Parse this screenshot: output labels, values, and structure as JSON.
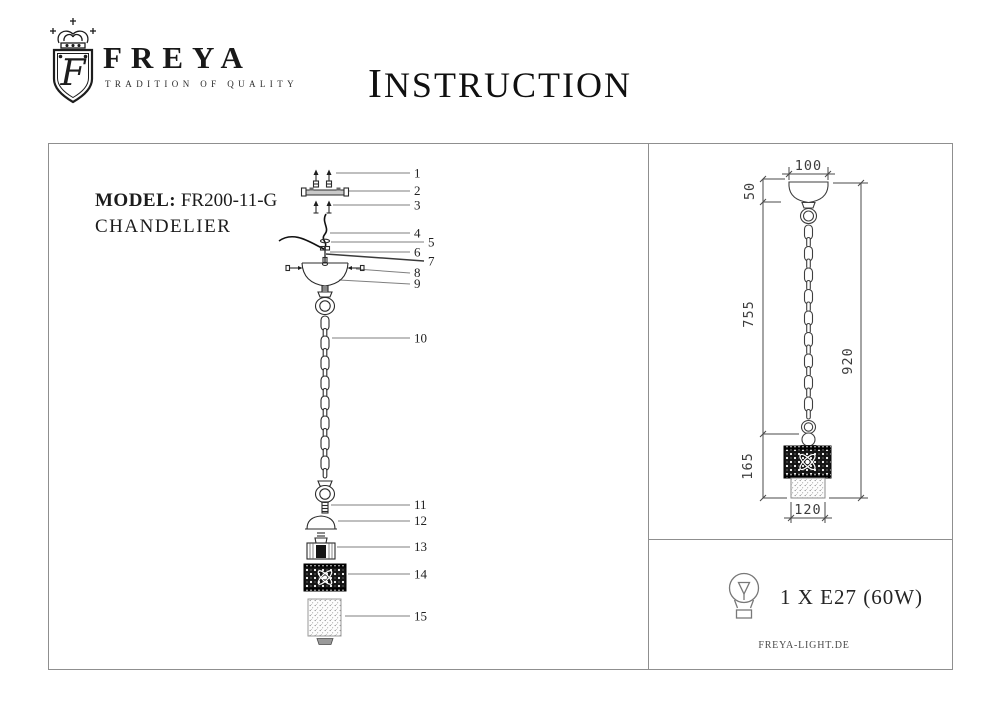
{
  "brand": {
    "name": "FREYA",
    "tagline": "TRADITION OF QUALITY",
    "monogram": "F"
  },
  "title": "INSTRUCTION",
  "model": {
    "label": "MODEL:",
    "value": "FR200-11-G",
    "type": "CHANDELIER"
  },
  "exploded_view": {
    "parts": [
      "1",
      "2",
      "3",
      "4",
      "5",
      "6",
      "7",
      "8",
      "9",
      "10",
      "11",
      "12",
      "13",
      "14",
      "15"
    ]
  },
  "dimension_drawing": {
    "canopy_width_mm": "100",
    "canopy_height_mm": "50",
    "suspension_length_mm": "755",
    "total_height_mm": "920",
    "shade_height_mm": "165",
    "shade_width_mm": "120"
  },
  "lamp_spec": {
    "text": "1 X E27 (60W)"
  },
  "footer": {
    "website": "FREYA-LIGHT.DE"
  },
  "colors": {
    "ink": "#1f1f1f",
    "line": "#4a4a4a",
    "leader": "#7f7f7f"
  }
}
